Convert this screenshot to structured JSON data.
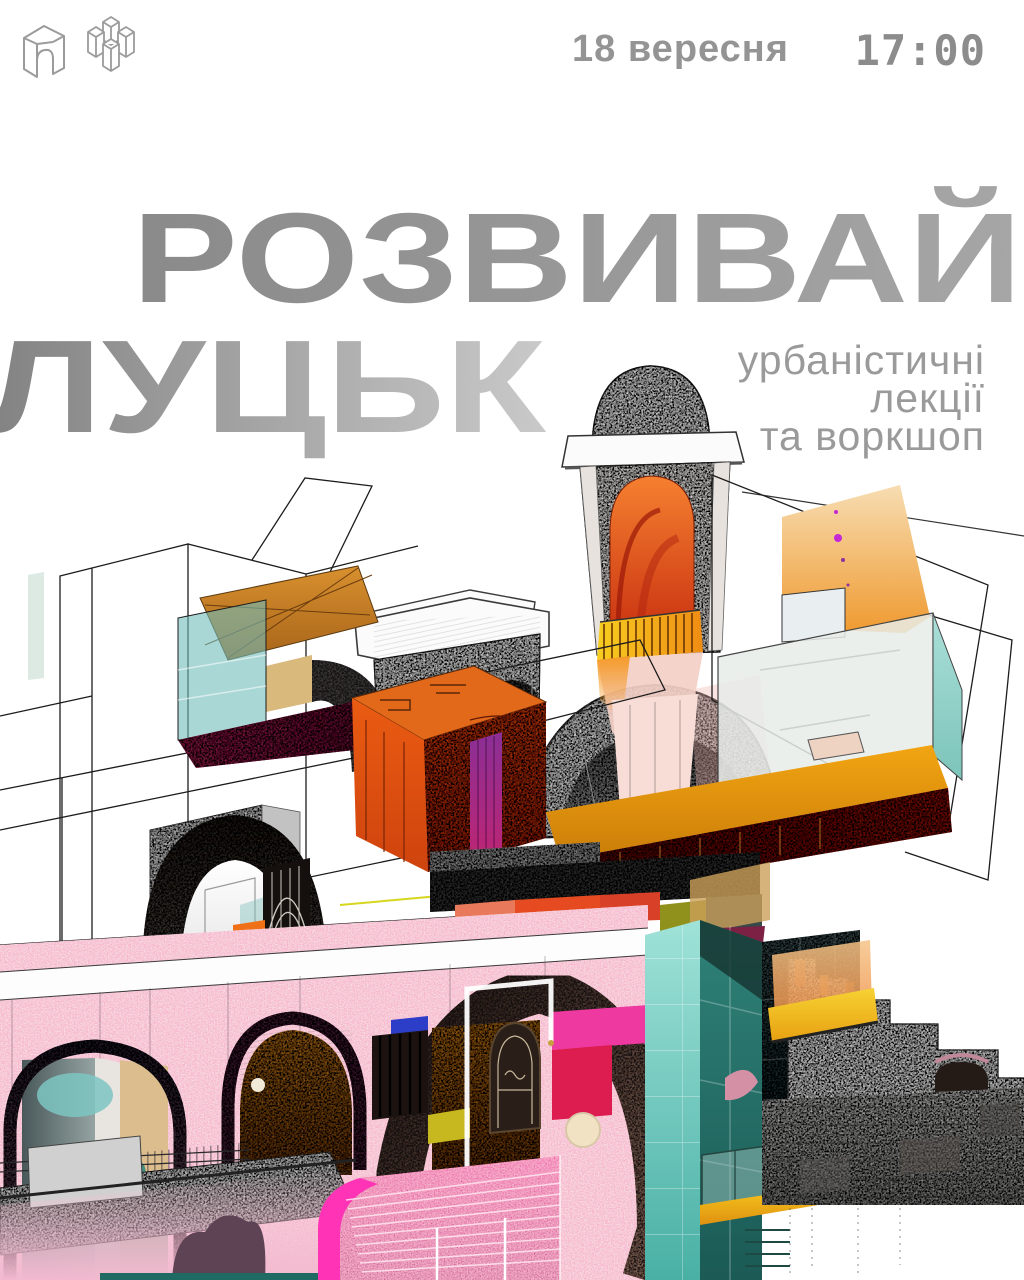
{
  "header": {
    "date": "18 вересня",
    "time": "17:00",
    "logos": [
      {
        "name": "arch-monument-logo"
      },
      {
        "name": "pillars-monument-logo"
      }
    ]
  },
  "title": {
    "line1": "РОЗВИВАЙ",
    "line2": "ЛУЦЬК"
  },
  "subtitle": {
    "line1": "урбаністичні",
    "line2": "лекції",
    "line3": "та воркшоп"
  },
  "illustration": {
    "alt": "Архітектурний колаж: графічний ескіз веж собору Луцька, поєднаний з кольоровими обʼємами, арками, скляними панелями, сходами та камʼяним муром"
  },
  "palette": {
    "text_gray": "#8c8c8c",
    "title_gray_dark": "#8a8a8a",
    "title_gray_light": "#c9c9c9",
    "accent_orange": "#e85a12",
    "accent_amber": "#f2a512",
    "accent_magenta": "#ee3aa0",
    "accent_maroon": "#96264f",
    "accent_purple": "#8a2f96",
    "accent_teal": "#6cbab9",
    "accent_cobalt": "#2c3ec8",
    "sketch_ink": "#3a3a3a",
    "bell_arch_orange": "#f58030",
    "balcony_yellow": "#f7ce20",
    "stairs_pink": "#ef2aa2",
    "stone_gray": "#a8a8a6"
  }
}
